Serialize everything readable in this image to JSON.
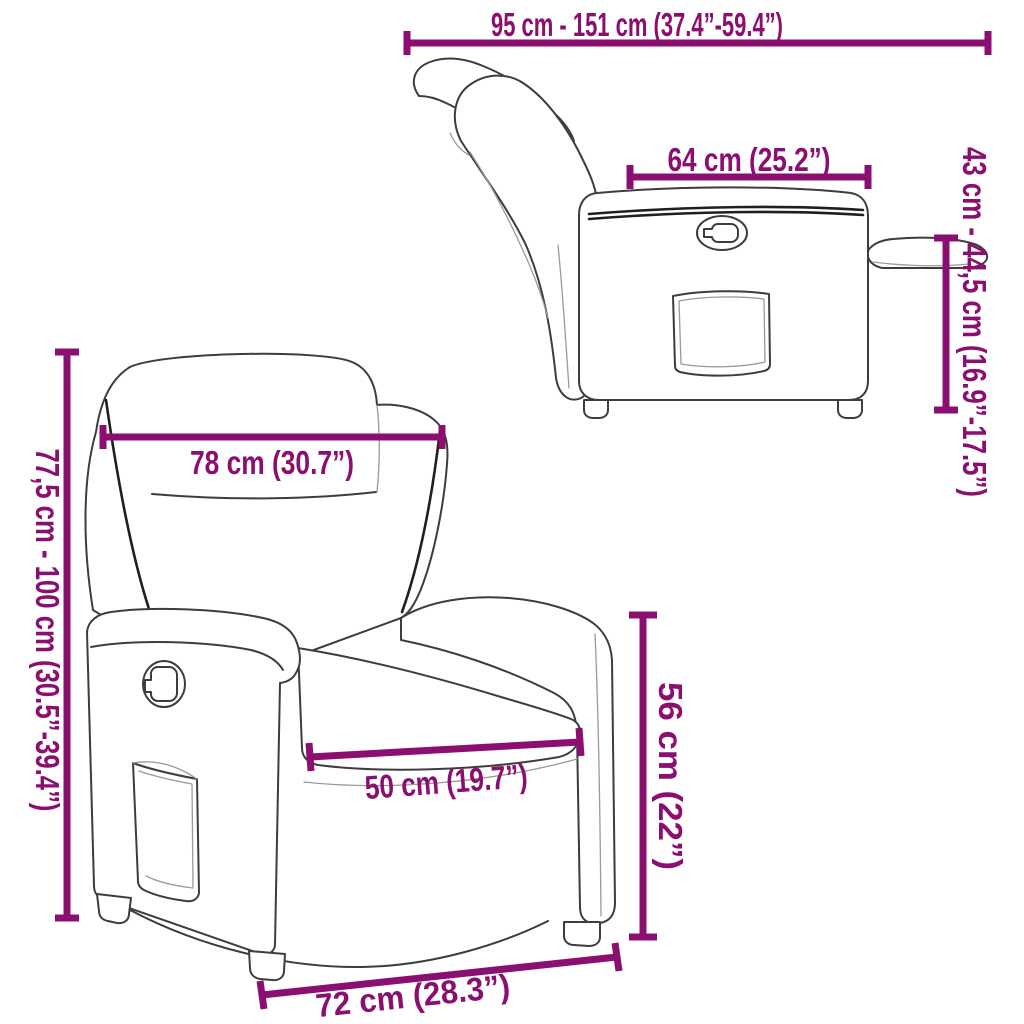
{
  "title": "Recliner chair dimension diagram",
  "colors": {
    "background": "#ffffff",
    "dimension": "#8B0F70",
    "outline": "#3d3d3d"
  },
  "views": {
    "side": "side view, backrest reclined with footrest extended",
    "front": "front three-quarter view"
  },
  "dimensions": [
    {
      "id": "overall-depth-range",
      "label": "95 cm - 151 cm (37.4”-59.4”)"
    },
    {
      "id": "seat-depth",
      "label": "64 cm (25.2”)"
    },
    {
      "id": "footrest-height-range",
      "label": "43 cm - 44,5 cm (16.9”-17.5”)"
    },
    {
      "id": "back-width",
      "label": "78 cm (30.7”)"
    },
    {
      "id": "total-height-range",
      "label": "77,5 cm - 100 cm (30.5”-39.4”)"
    },
    {
      "id": "seat-width",
      "label": "50 cm (19.7”)"
    },
    {
      "id": "seat-height",
      "label": "56 cm (22”)"
    },
    {
      "id": "base-width",
      "label": "72 cm (28.3”)"
    }
  ]
}
